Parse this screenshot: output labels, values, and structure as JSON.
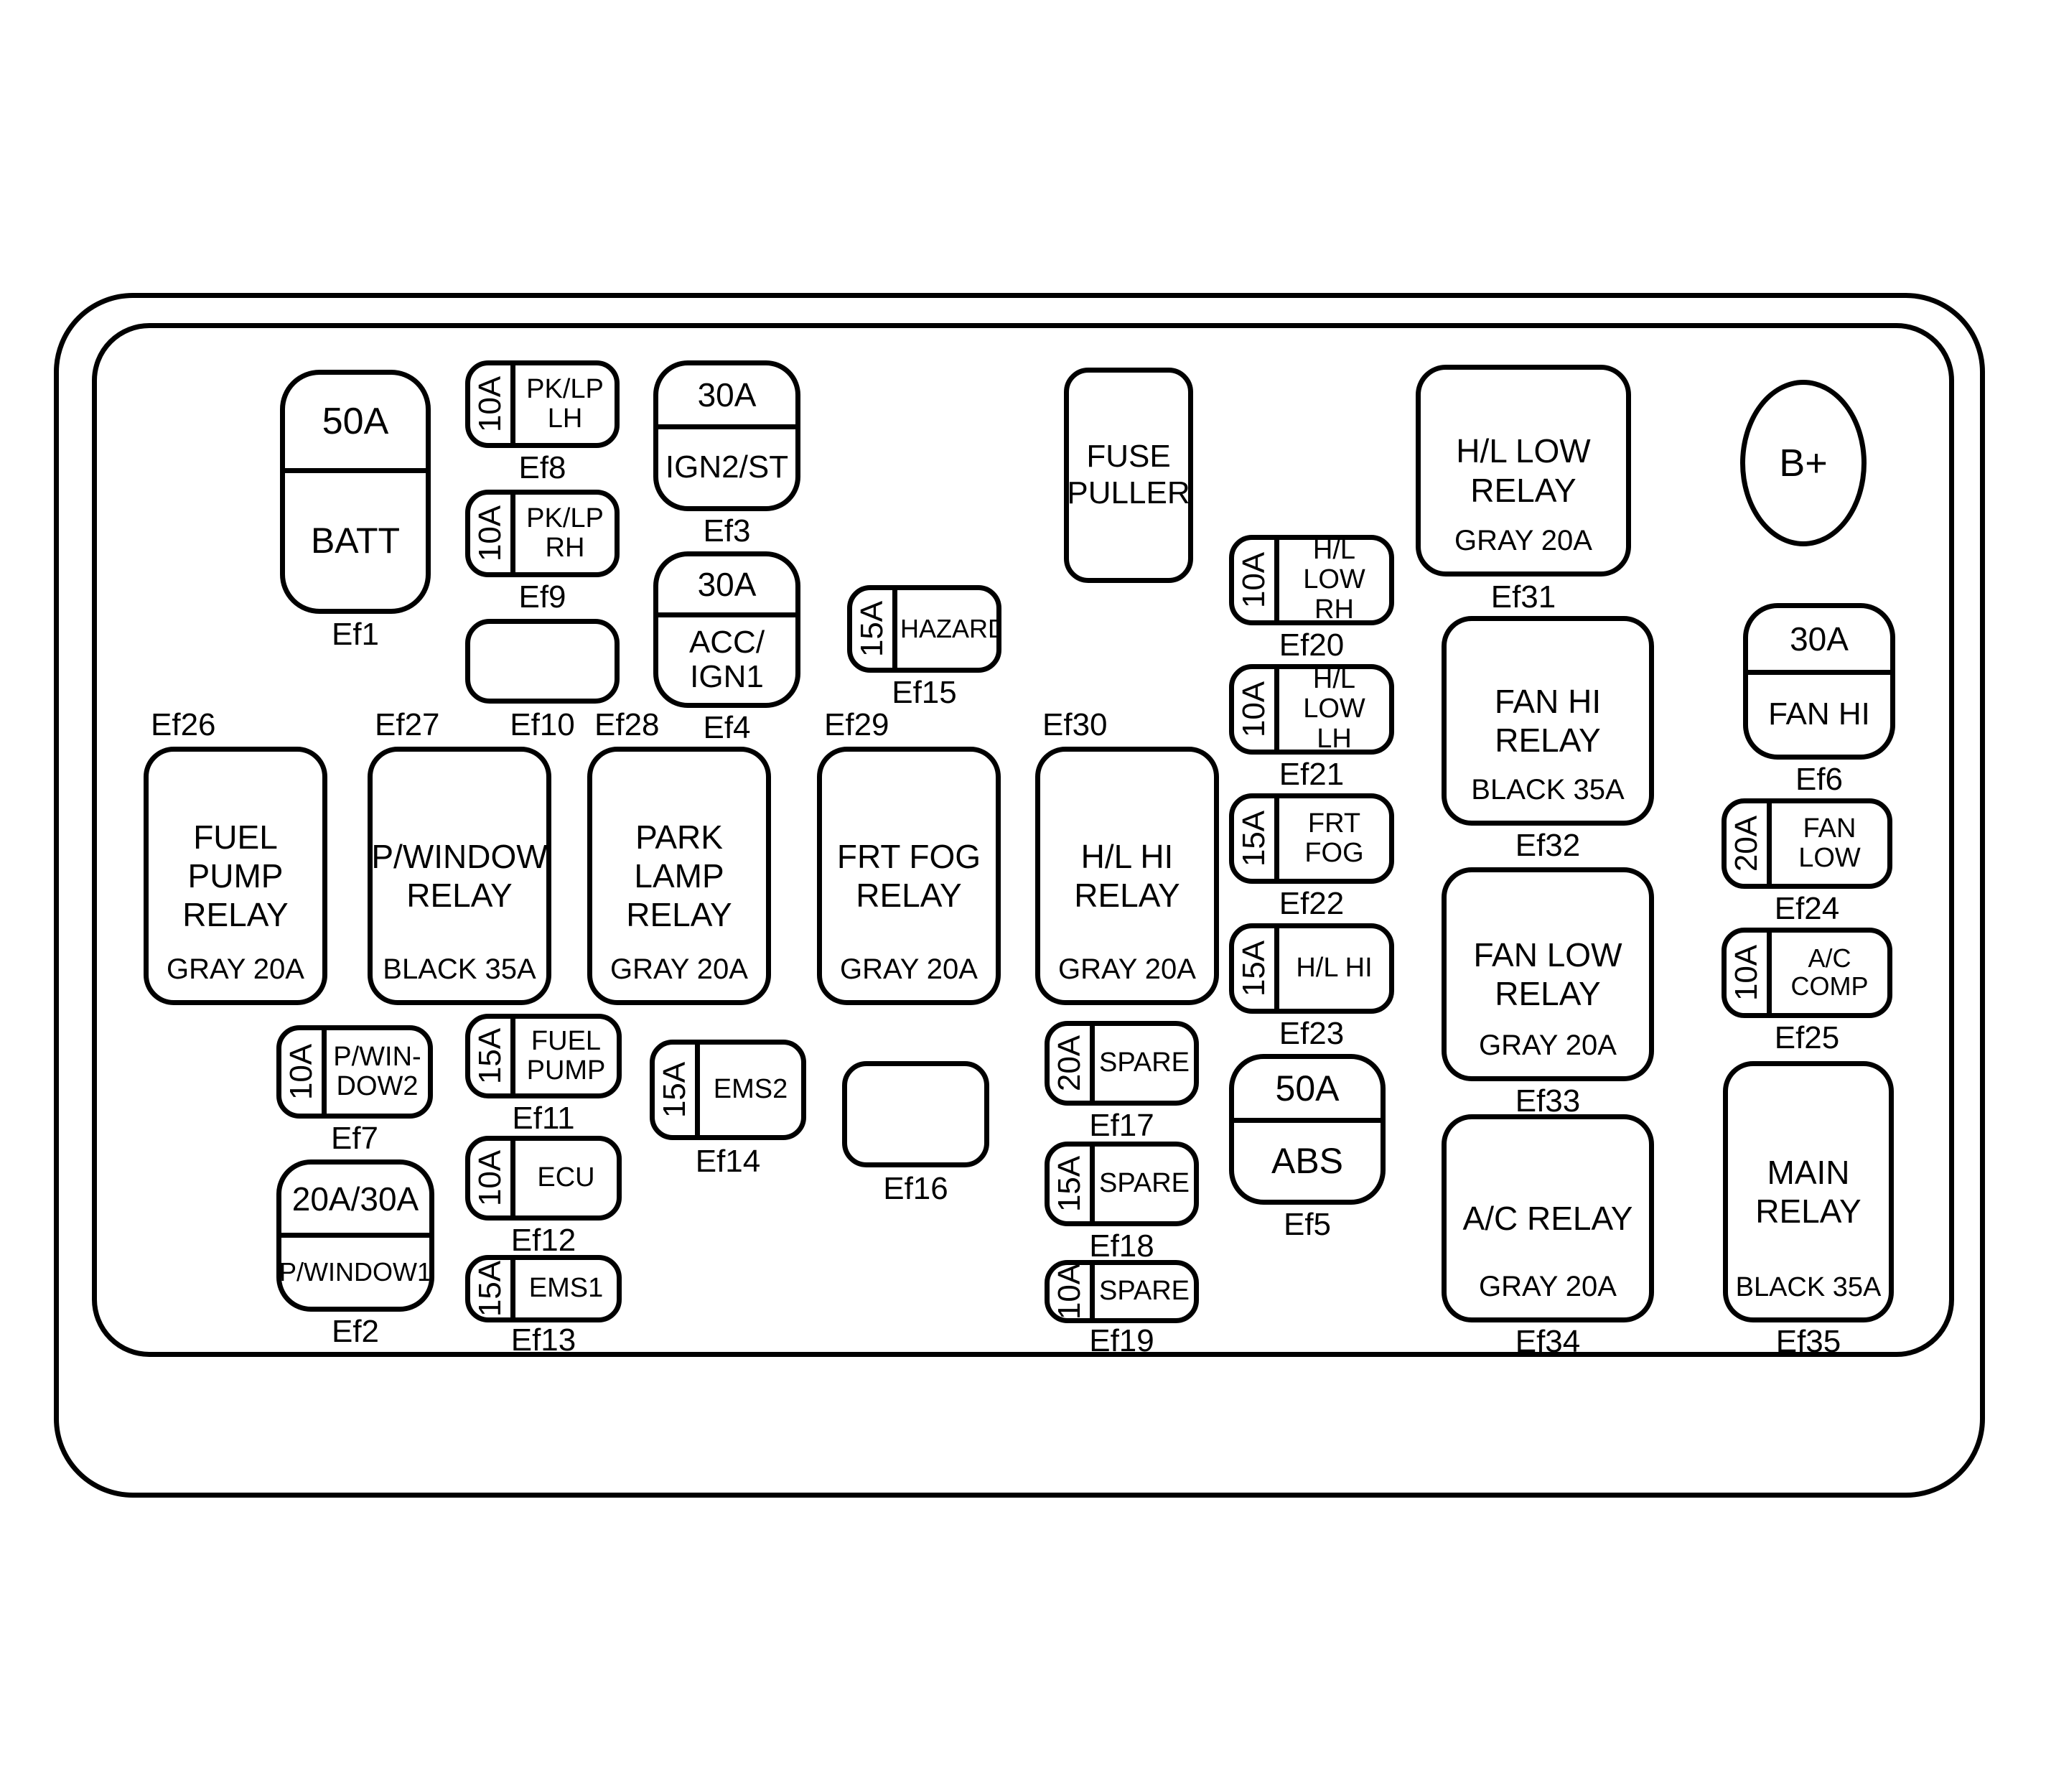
{
  "colors": {
    "line": "#000000",
    "background": "#ffffff"
  },
  "misc": {
    "fuse_puller": "FUSE\nPULLER",
    "battery_terminal": "B+"
  },
  "items": {
    "ef1": {
      "amp": "50A",
      "label": "BATT",
      "caption": "Ef1"
    },
    "ef2": {
      "amp": "20A/30A",
      "label": "P/WINDOW1",
      "caption": "Ef2"
    },
    "ef3": {
      "amp": "30A",
      "label": "IGN2/ST",
      "caption": "Ef3"
    },
    "ef4": {
      "amp": "30A",
      "label": "ACC/\nIGN1",
      "caption": "Ef4"
    },
    "ef5": {
      "amp": "50A",
      "label": "ABS",
      "caption": "Ef5"
    },
    "ef6": {
      "amp": "30A",
      "label": "FAN HI",
      "caption": "Ef6"
    },
    "ef7": {
      "amp": "10A",
      "label": "P/WIN-\nDOW2",
      "caption": "Ef7"
    },
    "ef8": {
      "amp": "10A",
      "label": "PK/LP LH",
      "caption": "Ef8"
    },
    "ef9": {
      "amp": "10A",
      "label": "PK/LP RH",
      "caption": "Ef9"
    },
    "ef10": {
      "caption": "Ef10"
    },
    "ef11": {
      "amp": "15A",
      "label": "FUEL\nPUMP",
      "caption": "Ef11"
    },
    "ef12": {
      "amp": "10A",
      "label": "ECU",
      "caption": "Ef12"
    },
    "ef13": {
      "amp": "15A",
      "label": "EMS1",
      "caption": "Ef13"
    },
    "ef14": {
      "amp": "15A",
      "label": "EMS2",
      "caption": "Ef14"
    },
    "ef15": {
      "amp": "15A",
      "label": "HAZARD",
      "caption": "Ef15"
    },
    "ef16": {
      "caption": "Ef16"
    },
    "ef17": {
      "amp": "20A",
      "label": "SPARE",
      "caption": "Ef17"
    },
    "ef18": {
      "amp": "15A",
      "label": "SPARE",
      "caption": "Ef18"
    },
    "ef19": {
      "amp": "10A",
      "label": "SPARE",
      "caption": "Ef19"
    },
    "ef20": {
      "amp": "10A",
      "label": "H/L LOW\nRH",
      "caption": "Ef20"
    },
    "ef21": {
      "amp": "10A",
      "label": "H/L LOW\nLH",
      "caption": "Ef21"
    },
    "ef22": {
      "amp": "15A",
      "label": "FRT FOG",
      "caption": "Ef22"
    },
    "ef23": {
      "amp": "15A",
      "label": "H/L HI",
      "caption": "Ef23"
    },
    "ef24": {
      "amp": "20A",
      "label": "FAN LOW",
      "caption": "Ef24"
    },
    "ef25": {
      "amp": "10A",
      "label": "A/C COMP",
      "caption": "Ef25"
    },
    "ef26": {
      "label": "FUEL PUMP\nRELAY",
      "color": "GRAY 20A",
      "caption": "Ef26"
    },
    "ef27": {
      "label": "P/WINDOW\nRELAY",
      "color": "BLACK 35A",
      "caption": "Ef27"
    },
    "ef28": {
      "label": "PARK LAMP\nRELAY",
      "color": "GRAY 20A",
      "caption": "Ef28"
    },
    "ef29": {
      "label": "FRT FOG\nRELAY",
      "color": "GRAY 20A",
      "caption": "Ef29"
    },
    "ef30": {
      "label": "H/L HI\nRELAY",
      "color": "GRAY 20A",
      "caption": "Ef30"
    },
    "ef31": {
      "label": "H/L LOW\nRELAY",
      "color": "GRAY 20A",
      "caption": "Ef31"
    },
    "ef32": {
      "label": "FAN HI\nRELAY",
      "color": "BLACK 35A",
      "caption": "Ef32"
    },
    "ef33": {
      "label": "FAN LOW\nRELAY",
      "color": "GRAY 20A",
      "caption": "Ef33"
    },
    "ef34": {
      "label": "A/C RELAY",
      "color": "GRAY 20A",
      "caption": "Ef34"
    },
    "ef35": {
      "label": "MAIN\nRELAY",
      "color": "BLACK 35A",
      "caption": "Ef35"
    }
  }
}
